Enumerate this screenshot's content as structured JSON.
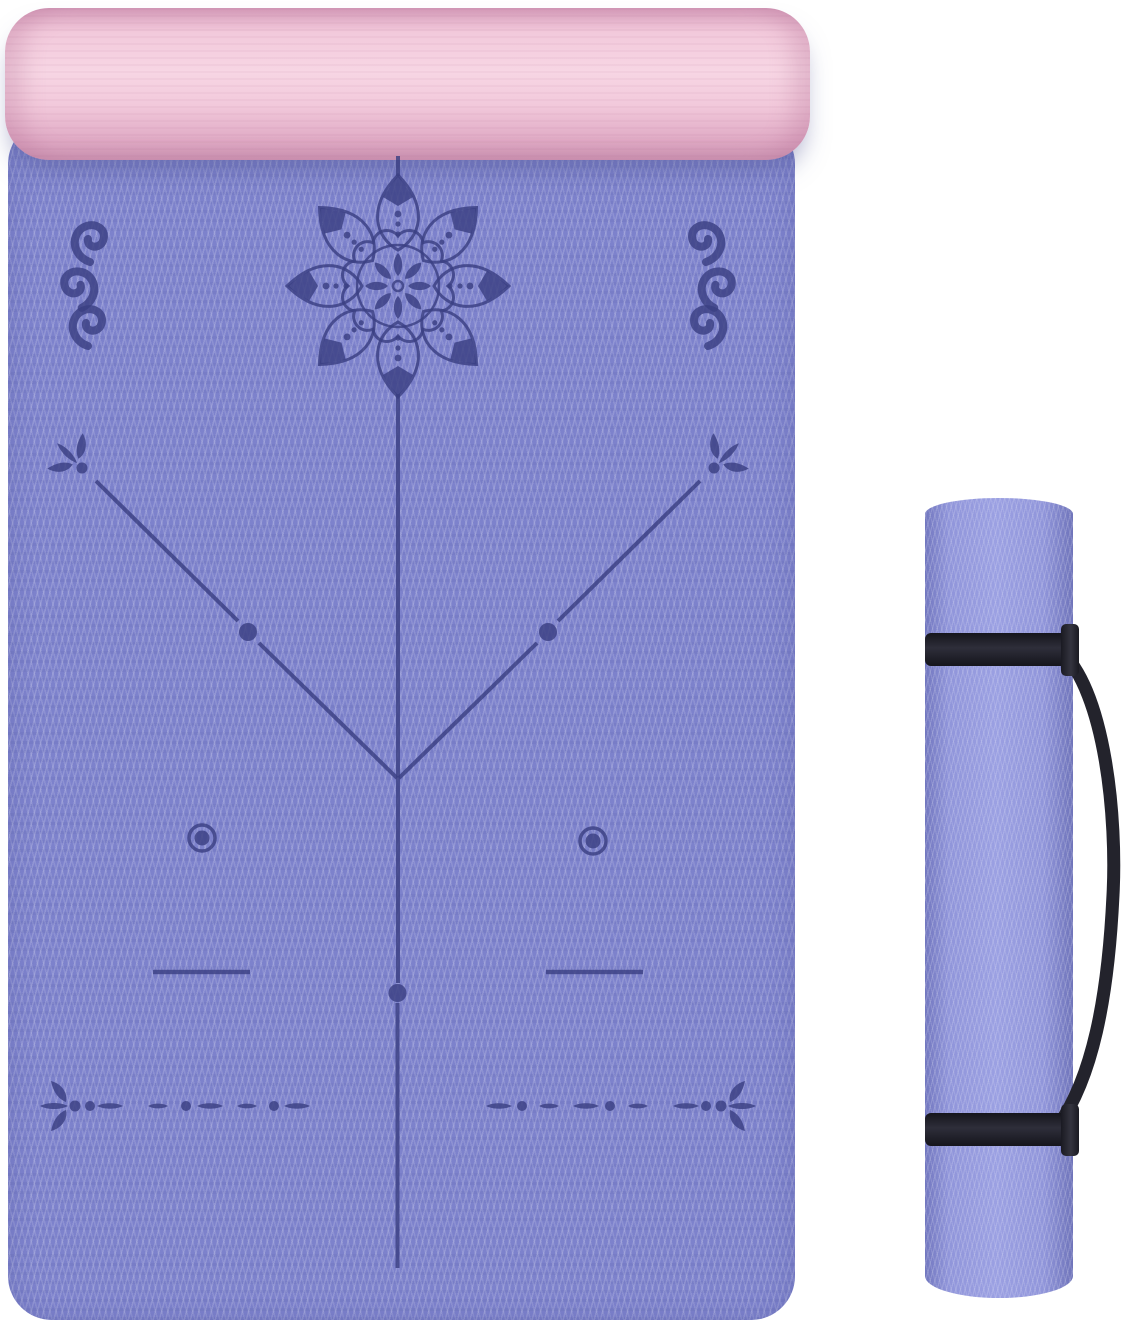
{
  "scene": {
    "type": "product-photo",
    "subject": "Two-tone yoga mat with body-alignment guide lines and lotus mandala print, shown unrolled with its pink reverse side rolled over at the top, next to a fully rolled mat secured by two black straps with a carrying sling",
    "text_content": "none"
  },
  "colors": {
    "background": "#ffffff",
    "mat_purple": "#7d82cc",
    "mat_texture_light": "#a6abe4",
    "design_navy": "#3a4082",
    "roll_pink": "#f2c9db",
    "roll_pink_dark": "#dfa9c4",
    "rolled_mat_purple": "#9095da",
    "rolled_mat_edge": "#7277bf",
    "strap_black": "#1d1d25",
    "shadow_purple": "#6a6fae"
  },
  "elements": {
    "pink_roll": "rolled-over pink top edge of the mat",
    "main_mat": "unrolled purple mat with chevron texture",
    "mandala": "lotus mandala with 8 petals, scalloped double ring, inner rosette and dotted petal axes",
    "scroll_ornaments": "stacked spiral curls near the two top corners",
    "alignment_lines": "center vertical line plus V-shaped guide lines with fleur-de-lis ends and dot markers",
    "hand_targets": "two concentric-circle placement markers",
    "position_dashes": "two short horizontal placement lines",
    "bottom_guides": "two dash-dot guide rows ending in fleur-de-lis motifs",
    "rolled_mat": "rolled purple mat standing vertically",
    "straps": "two black securing bands and a curved shoulder sling"
  }
}
